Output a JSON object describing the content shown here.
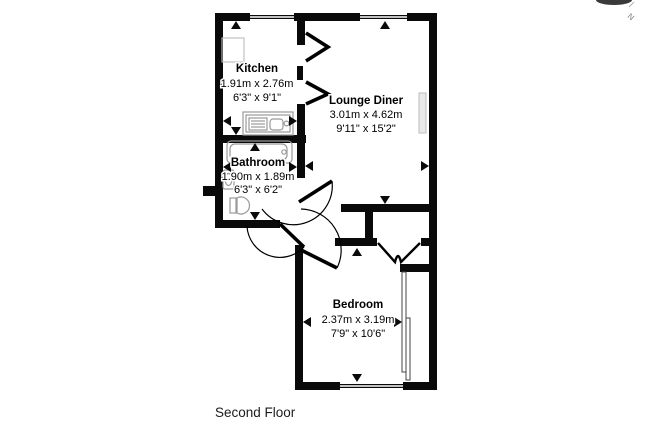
{
  "floor_label": "Second Floor",
  "compass": {
    "north_label": "N"
  },
  "rooms": [
    {
      "name": "Kitchen",
      "metric": "1.91m x 2.76m",
      "imperial": "6'3\" x 9'1\""
    },
    {
      "name": "Lounge Diner",
      "metric": "3.01m x 4.62m",
      "imperial": "9'11\" x 15'2\""
    },
    {
      "name": "Bathroom",
      "metric": "1.90m x 1.89m",
      "imperial": "6'3\" x 6'2\""
    },
    {
      "name": "Bedroom",
      "metric": "2.37m x 3.19m",
      "imperial": "7'9\" x 10'6\""
    }
  ],
  "fixtures": [
    "bathtub",
    "wash-basin",
    "toilet",
    "kitchen-sink",
    "kitchen-counter",
    "radiator",
    "wardrobe-sliding-doors"
  ],
  "colors": {
    "wall": "#0a0a0a",
    "background": "#ffffff",
    "fixture_outline": "#999999",
    "text": "#000000"
  }
}
